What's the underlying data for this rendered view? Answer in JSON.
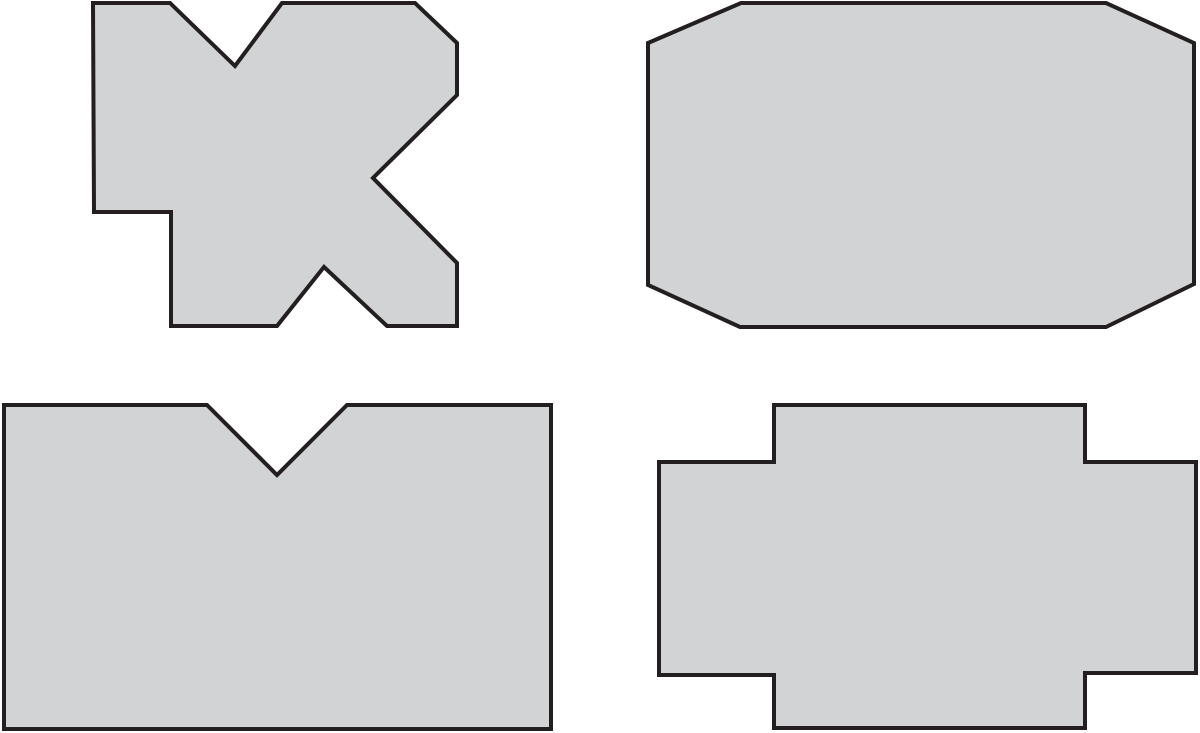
{
  "canvas": {
    "width": 1200,
    "height": 733,
    "background_color": "#ffffff"
  },
  "style": {
    "shape_fill_color": "#d1d3d4",
    "shape_stroke_color": "#231f20",
    "shape_stroke_width": "4"
  },
  "shapes": [
    {
      "name": "x-shaped-concave-polygon",
      "position": "top-left",
      "description": "irregular concave polygon with V-notch on top, V-notch on bottom, notch on right side and rectangular step cut from lower-left",
      "points": "93,3 170,3 235,66 282,3 415,3 457,43 457,95 373,178 457,263 457,326 387,326 324,267 277,326 171,326 171,212 94,212"
    },
    {
      "name": "octagon-polygon",
      "position": "top-right",
      "description": "wide octagon - rectangle with four corners cut diagonally",
      "points": "741,3 1106,3 1194,43 1194,284 1106,327 740,327 648,285 648,43"
    },
    {
      "name": "notched-rectangle-polygon",
      "position": "bottom-left",
      "description": "rectangle with triangular V-notch cut into top edge",
      "points": "4,405 207,405 277,475 347,405 551,405 551,729 4,729"
    },
    {
      "name": "stepped-cross-polygon",
      "position": "bottom-right",
      "description": "cross / plus shaped polygon with tall center block and short side arms",
      "points": "774,405 1085,405 1085,462 1196,462 1196,673 1085,673 1085,728 774,728 774,675 659,675 659,462 774,462"
    }
  ]
}
